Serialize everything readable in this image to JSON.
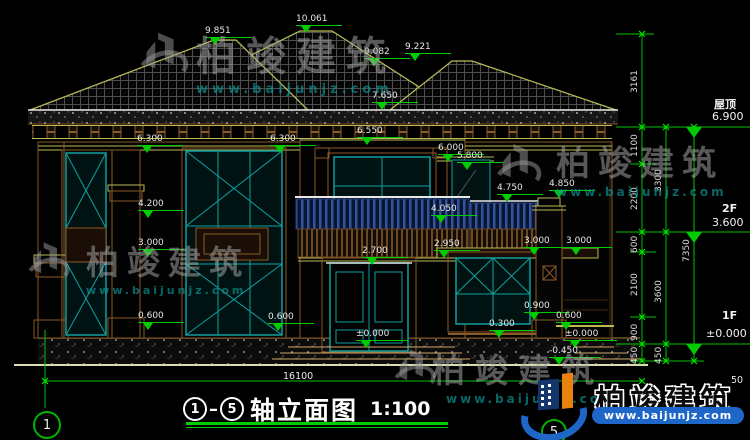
{
  "drawing": {
    "title": {
      "axis_from": "1",
      "axis_to": "5",
      "text": "轴立面图",
      "scale": "1:100"
    },
    "axis_bubbles": {
      "left": "1",
      "bottom": "5"
    },
    "total_width_dim": "16100",
    "elev": [
      "9.851",
      "10.061",
      "9.082",
      "9.221",
      "7.650",
      "6.300",
      "6.300",
      "6.550",
      "6.000",
      "5.800",
      "4.750",
      "4.850",
      "4.200",
      "4.050",
      "3.000",
      "2.700",
      "2.950",
      "3.000",
      "3.000",
      "0.600",
      "0.600",
      "0.900",
      "0.600",
      "0.300",
      "±0.000",
      "±0.000",
      "-0.450"
    ],
    "levels": [
      {
        "label": "屋顶",
        "value": "6.900"
      },
      {
        "label": "2F",
        "value": "3.600"
      },
      {
        "label": "1F",
        "value": "±0.000"
      }
    ],
    "chain": {
      "a": [
        "3161",
        "1100",
        "2200",
        "600",
        "2100",
        "900",
        "450"
      ],
      "b": [
        "3300",
        "3600",
        "450"
      ],
      "c": [
        "7350"
      ],
      "partial": "50"
    }
  },
  "watermark": {
    "brand": "柏竣建筑",
    "site": "www.baijunjz.com"
  },
  "colors": {
    "annotation_green": "#00cc00",
    "cad_olive": "#b9b956",
    "wall_brown": "#8a5a28",
    "window_teal": "#0fa0a0",
    "railing_navy": "#33549e",
    "logo_blue": "#1e66c7",
    "logo_orange": "#e8820c",
    "dim_text": "#e8e8e8"
  }
}
